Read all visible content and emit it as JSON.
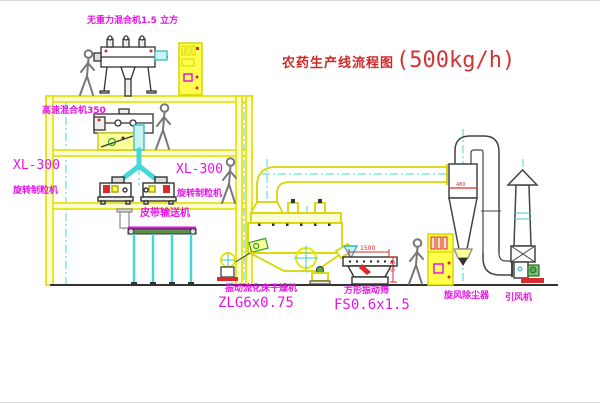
{
  "title": {
    "cn": "农药生产线流程图",
    "capacity": "(500kg/h)"
  },
  "labels": {
    "gravity_mixer": "无重力混合机1.5 立方",
    "highspeed_mixer": "高速混合机350",
    "granulator_model_left": "XL-300",
    "granulator_name_left": "旋转制粒机",
    "granulator_model_right": "XL-300",
    "granulator_name_right": "旋转制粒机",
    "belt_conveyor": "皮带输送机",
    "dryer_name": "振动流化床干燥机",
    "dryer_model": "ZLG6x0.75",
    "sieve_name": "方形振动筛",
    "sieve_model": "FS0.6x1.5",
    "cyclone": "旋风除尘器",
    "fan": "引风机"
  },
  "dimensions": {
    "sieve_width": "1500",
    "sieve_height": "945",
    "cyclone_dim": "480"
  },
  "colors": {
    "line_yellow": "#e0e000",
    "label_magenta": "#e813e8",
    "title_red": "#cc2a2a",
    "pipe_cyan": "#45d8d8",
    "dim_red": "#d92b2b"
  }
}
